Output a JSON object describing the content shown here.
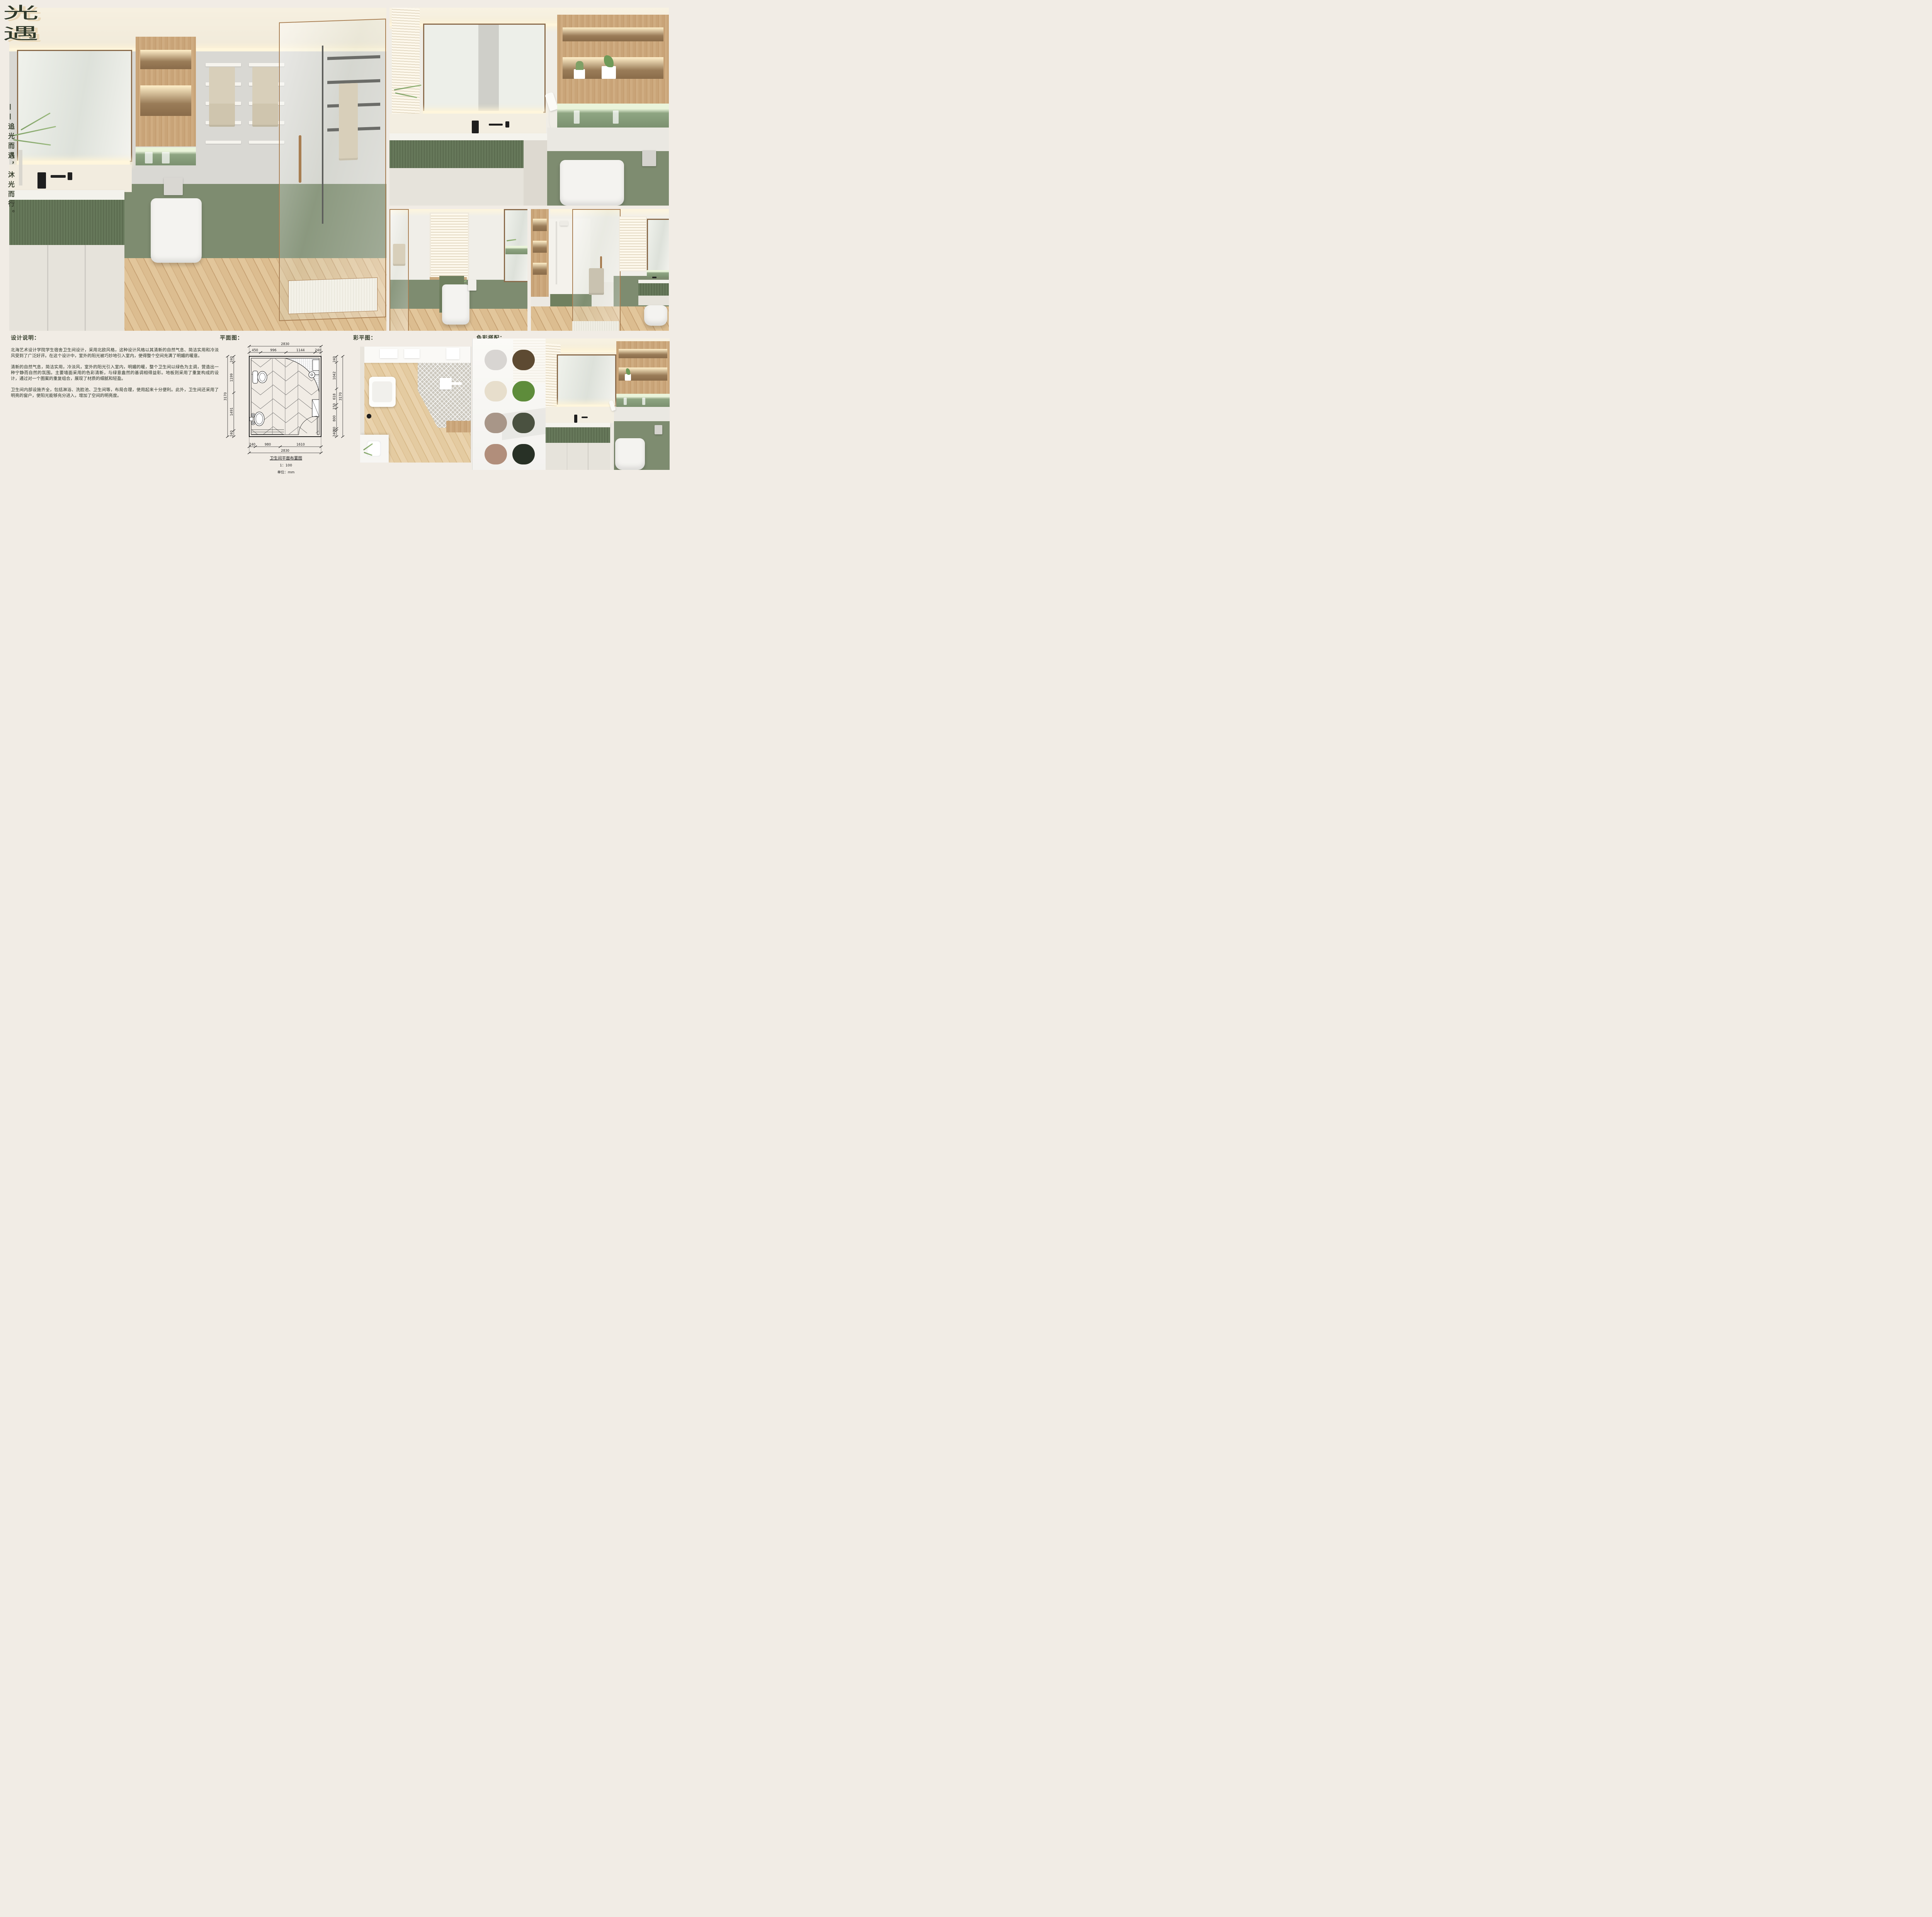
{
  "board": {
    "title": {
      "char1": "光",
      "char2": "遇"
    },
    "subtitle": "——追光而遇，沐光而行。"
  },
  "sections": {
    "description": {
      "heading": "设计说明：",
      "paragraphs": [
        "北海艺术设计学院学生宿舍卫生间设计，采用北欧风格，这种设计风格以其清新的自然气息、简洁实用和冷淡风受到了广泛好评。在这个设计中，室外的阳光被巧妙地引入室内，使得整个空间充满了明媚的暖意。",
        "清新的自然气息，简洁实用，冷淡风，室外的阳光引入室内，明媚的暖，整个卫生间以绿色为主调，营造出一种宁静而自然的氛围。主要墙面采用的色彩清新，与绿意盎然的基调相得益彰。地板则采用了重复构成的设计，通过对一个图案的重复组合，展现了材质的细腻和轻盈。",
        "卫生间内部设施齐全，包括淋浴、洗脸池、卫生间等，布局合理，使用起来十分便利。此外，卫生间还采用了明亮的窗户，使阳光能够充分进入，增加了空间的明亮度。"
      ]
    },
    "floor_plan": {
      "heading": "平面图：",
      "caption": {
        "title": "卫生间平面布置图",
        "scale": "1：100",
        "unit": "单位：mm"
      },
      "dimensions": {
        "top_overall": "2830",
        "top_segments": [
          "450",
          "996",
          "1144",
          "240"
        ],
        "bottom_segments": [
          "240",
          "980",
          "1610"
        ],
        "bottom_overall": "2830",
        "left_overall": "3170",
        "left_segments": [
          "240",
          "1199",
          "1491",
          "240"
        ],
        "right_overall": "3170",
        "right_segments": [
          "240",
          "1042",
          "618",
          "150",
          "800",
          "80",
          "240"
        ]
      }
    },
    "color_plan": {
      "heading": "彩平图："
    },
    "palette": {
      "heading": "色彩搭配：",
      "swatches": [
        {
          "name": "light-warm-gray",
          "hex": "#D8D5D2"
        },
        {
          "name": "dark-umber-brown",
          "hex": "#5D4A32"
        },
        {
          "name": "warm-cream",
          "hex": "#E7DECC"
        },
        {
          "name": "leaf-green",
          "hex": "#5E8C3B"
        },
        {
          "name": "warm-taupe",
          "hex": "#A89688"
        },
        {
          "name": "olive-green",
          "hex": "#4A5140"
        },
        {
          "name": "rosy-brown",
          "hex": "#B18E7B"
        },
        {
          "name": "deep-forest-green",
          "hex": "#283126"
        }
      ]
    }
  },
  "colors": {
    "board_bg": "#F1ECE5",
    "title_ink": "#2E3829",
    "title_shadow": "#E9D7B6",
    "heading_ink": "#39412F",
    "body_ink": "#2B3227",
    "green_wall": "#7E8C70",
    "upper_wall": "#D9D8D3",
    "frame_bronze": "#A87E52",
    "mirror_frame": "#8A6B4B",
    "cove_light": "#FFF6DC",
    "towel": "#D8CFBA"
  }
}
